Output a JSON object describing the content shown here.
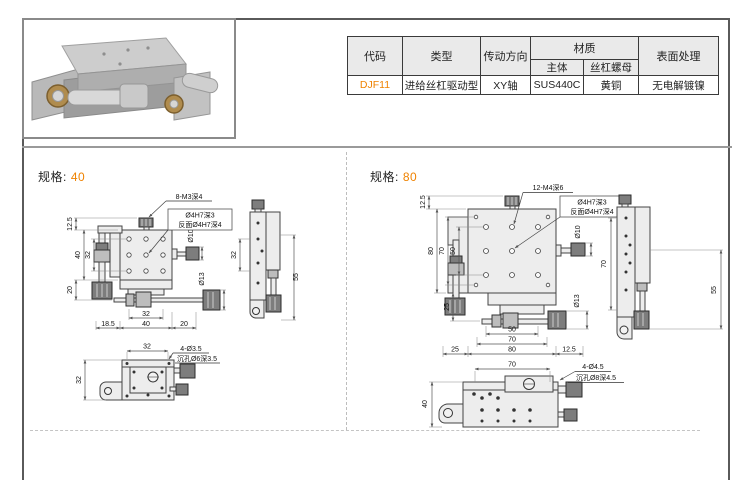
{
  "colors": {
    "accent": "#ef8200",
    "line": "#444444",
    "header_bg": "#eaeaea"
  },
  "table": {
    "headers": {
      "code": "代码",
      "type": "类型",
      "direction": "传动方向",
      "material": "材质",
      "material_body": "主体",
      "material_nut": "丝杠螺母",
      "surface": "表面处理"
    },
    "row": {
      "code": "DJF11",
      "type": "进给丝杠驱动型",
      "direction": "XY轴",
      "material_body": "SUS440C",
      "material_nut": "黄铜",
      "surface": "无电解镀镍"
    }
  },
  "spec40": {
    "label": "规格:",
    "size": "40",
    "callout_holes": "8-M3深4",
    "callout_pin": "Ø4H7深3",
    "callout_pin_back": "反面Ø4H7深4",
    "callout_cbore_count": "4-Ø3.5",
    "callout_cbore": "沉孔Ø6深3.5",
    "front": {
      "left": [
        "12.5",
        "40",
        "32",
        "20"
      ],
      "bottom": [
        "18.5",
        "40",
        "20"
      ],
      "bottom_inner": "32",
      "right": [
        "Ø10",
        "Ø13"
      ]
    },
    "side": {
      "left": "32",
      "right": "55"
    },
    "bottom_view": {
      "top": "32",
      "left": "32"
    }
  },
  "spec80": {
    "label": "规格:",
    "size": "80",
    "callout_holes": "12-M4深6",
    "callout_pin": "Ø4H7深3",
    "callout_pin_back": "反面Ø4H7深4",
    "callout_cbore_count": "4-Ø4.5",
    "callout_cbore": "沉孔Ø8深4.5",
    "front": {
      "left": [
        "12.5",
        "80",
        "70",
        "50",
        "25"
      ],
      "bottom": [
        "50",
        "70",
        "25",
        "80",
        "12.5"
      ],
      "right": [
        "Ø10",
        "Ø13"
      ]
    },
    "side": {
      "left": "70",
      "right": "55"
    },
    "bottom_view": {
      "top": "70",
      "left": "40"
    }
  }
}
